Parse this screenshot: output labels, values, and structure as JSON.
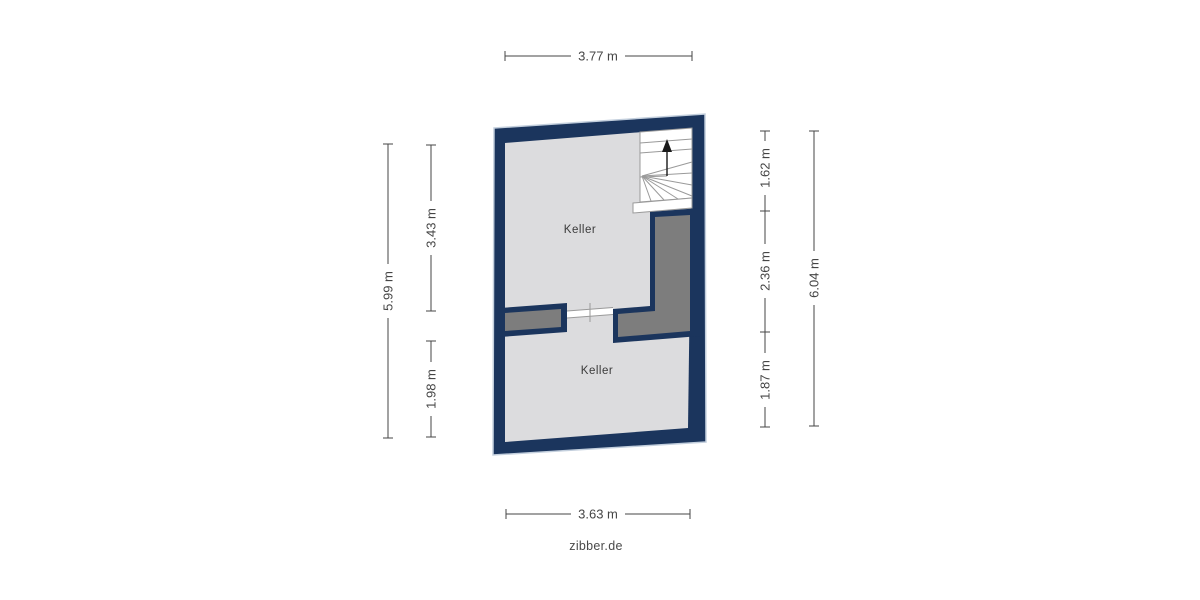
{
  "watermark": "zibber.de",
  "floorplan": {
    "type": "basement-floor-plan",
    "rooms": [
      {
        "label": "Keller"
      },
      {
        "label": "Keller"
      }
    ],
    "staircase": {
      "direction": "up",
      "style": "winder"
    },
    "dimensions": {
      "top": "3.77 m",
      "bottom": "3.63 m",
      "left_outer": "5.99 m",
      "left_inner_top": "3.43 m",
      "left_inner_bottom": "1.98 m",
      "right_inner_top": "1.62 m",
      "right_inner_middle": "2.36 m",
      "right_inner_bottom": "1.87 m",
      "right_outer": "6.04 m"
    },
    "colors": {
      "bg": "#ffffff",
      "wall": "#1b355d",
      "wall-halo": "#c3cfdd",
      "floor": "#dcdcde",
      "interior-fill": "#7d7d7d",
      "stair-line": "#9a9a9a",
      "dim": "#454545",
      "label": "#3a3a3a"
    }
  }
}
